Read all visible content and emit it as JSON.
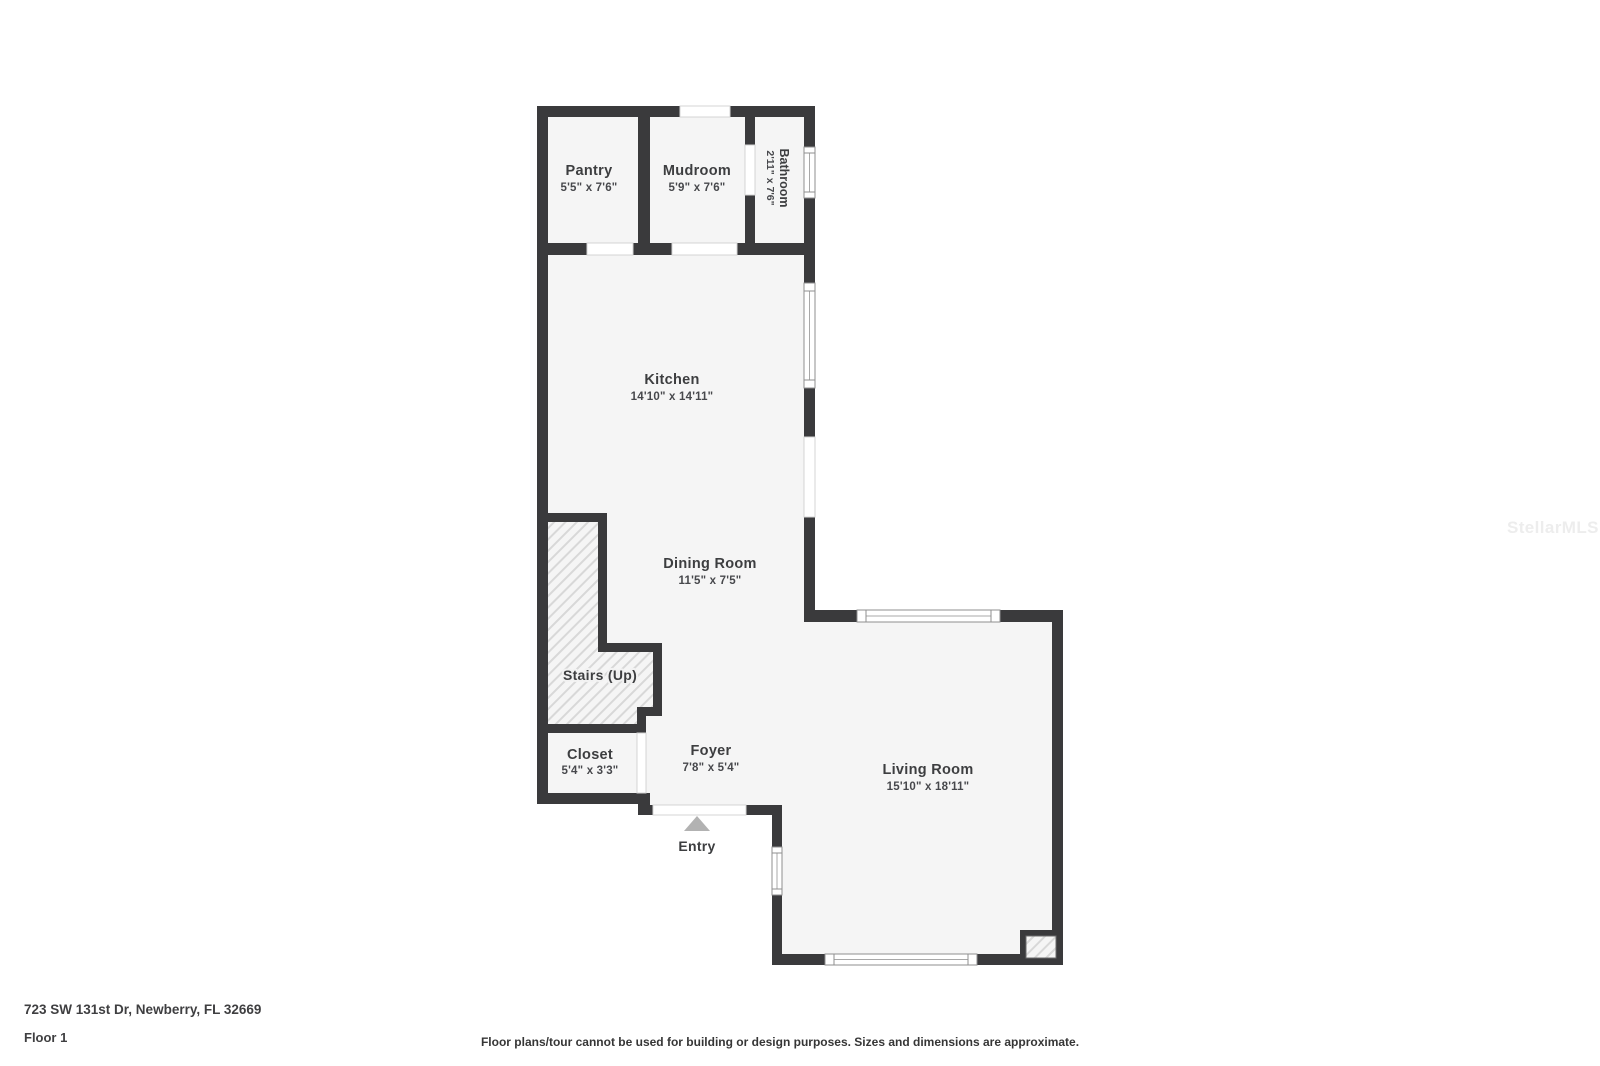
{
  "plan": {
    "rooms": [
      {
        "id": "pantry",
        "name": "Pantry",
        "dims": "5'5\" x 7'6\""
      },
      {
        "id": "mudroom",
        "name": "Mudroom",
        "dims": "5'9\" x 7'6\""
      },
      {
        "id": "bathroom",
        "name": "Bathroom",
        "dims": "2'11\" x 7'6\""
      },
      {
        "id": "kitchen",
        "name": "Kitchen",
        "dims": "14'10\" x 14'11\""
      },
      {
        "id": "dining",
        "name": "Dining Room",
        "dims": "11'5\" x 7'5\""
      },
      {
        "id": "stairs",
        "name": "Stairs (Up)"
      },
      {
        "id": "closet",
        "name": "Closet",
        "dims": "5'4\" x 3'3\""
      },
      {
        "id": "foyer",
        "name": "Foyer",
        "dims": "7'8\" x 5'4\""
      },
      {
        "id": "living",
        "name": "Living Room",
        "dims": "15'10\" x 18'11\""
      },
      {
        "id": "entry",
        "name": "Entry"
      }
    ]
  },
  "footer": {
    "address": "723 SW 131st Dr, Newberry, FL 32669",
    "floor": "Floor 1",
    "disclaimer": "Floor plans/tour cannot be used for building or design purposes. Sizes and dimensions are approximate."
  },
  "watermark": {
    "text": "StellarMLS"
  },
  "colors": {
    "wall": "#3a3a3c",
    "floor": "#f5f5f5",
    "hatch": "#d8d8d8",
    "entry_arrow": "#b2b2b2",
    "watermark": "#ededed",
    "label_text": "#3d3e40"
  }
}
